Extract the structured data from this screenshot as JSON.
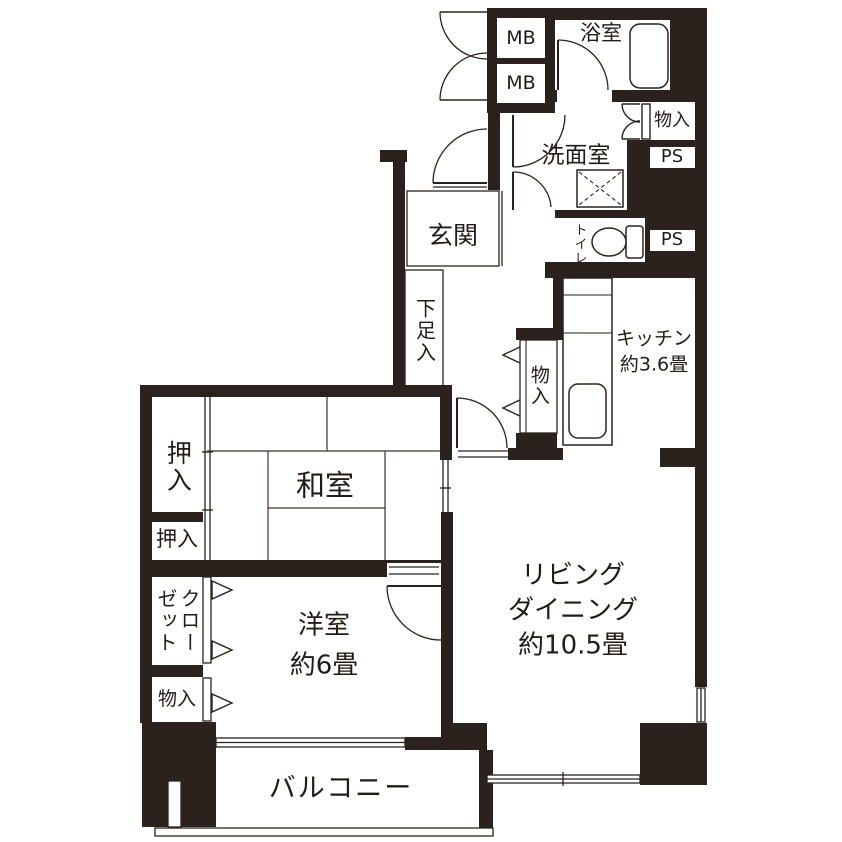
{
  "title": "apartment-floor-plan",
  "colors": {
    "wall": "#2b221d",
    "line": "#2b221d",
    "tatami_line": "#3c332d",
    "text": "#231b17",
    "bg": "#ffffff"
  },
  "labels": {
    "mb1": "MB",
    "mb2": "MB",
    "bathroom": "浴室",
    "washroom": "洗面室",
    "storage_top": "物入",
    "ps1": "PS",
    "ps2": "PS",
    "toilet": "トイレ",
    "genkan": "玄関",
    "shoe_cabinet": "下足入",
    "kitchen": "キッチン\n約3.6畳",
    "storage_hall": "物入",
    "oshiire_upper": "押入",
    "oshiire_lower": "押入",
    "washitsu": "和室",
    "closet": "クロー\nゼット",
    "storage_west": "物入",
    "youshitsu": "洋室\n約6畳",
    "living_dining": "リビング\nダイニング\n約10.5畳",
    "balcony": "バルコニー"
  }
}
